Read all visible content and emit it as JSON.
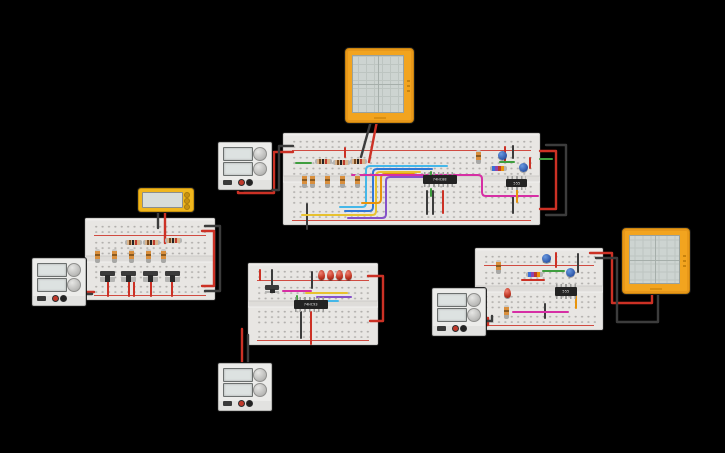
{
  "canvas": {
    "width": 725,
    "height": 453,
    "background": "#000000",
    "kind": "circuit-design-workspace"
  },
  "palette": {
    "wire_red": "#cc3125",
    "wire_black": "#3c3c3c",
    "wire_yellow": "#e7c12f",
    "wire_orange": "#e8940c",
    "wire_cyan": "#45b7e8",
    "wire_blue": "#3178d6",
    "wire_purple": "#8551c9",
    "wire_magenta": "#d62fa4",
    "wire_green": "#3f9e3f",
    "breadboard_body": "#e8e6e3",
    "rail_line_red": "#d04b41",
    "scope_frame": "#f2a41f",
    "scope_screen": "#cdd4d1",
    "meter_body": "#f0b71d",
    "psu_body": "#ececea",
    "ic_body": "#232323",
    "led_red": "#c23a28",
    "capacitor_blue": "#2c55a8",
    "resistor_tan": "#d9b48c"
  },
  "ics": {
    "and_gate_top": {
      "label": "74HC08"
    },
    "timer_top": {
      "label": "555"
    },
    "counter_mid": {
      "label": "74HC93"
    },
    "timer_right": {
      "label": "555"
    }
  },
  "instruments": {
    "power_supplies": [
      {
        "id": "power-supply-1",
        "position": "top-left"
      },
      {
        "id": "power-supply-2",
        "position": "left"
      },
      {
        "id": "power-supply-3",
        "position": "bottom-middle"
      },
      {
        "id": "power-supply-4",
        "position": "right"
      }
    ],
    "oscilloscopes": [
      {
        "id": "oscilloscope-1",
        "position": "top"
      },
      {
        "id": "oscilloscope-2",
        "position": "right"
      }
    ],
    "multimeters": [
      {
        "id": "multimeter-1",
        "position": "left"
      }
    ]
  },
  "boards": {
    "top": {
      "horizontal_resistors": 3,
      "vertical_resistors": 6,
      "capacitors": 2,
      "ics": 2,
      "jumper_colors": [
        "cyan",
        "blue",
        "yellow",
        "orange",
        "purple",
        "magenta",
        "green",
        "red",
        "black"
      ]
    },
    "left": {
      "horizontal_resistors": 3,
      "vertical_resistors": 5,
      "slide_switches": 4,
      "jumper_colors": [
        "red",
        "black"
      ]
    },
    "middle": {
      "leds": 4,
      "slide_switches": 1,
      "ics": 1,
      "jumper_colors": [
        "magenta",
        "yellow",
        "purple",
        "cyan",
        "green",
        "red",
        "black"
      ]
    },
    "right": {
      "leds": 1,
      "capacitors": 2,
      "resistors": 3,
      "ics": 1,
      "jumper_colors": [
        "magenta",
        "green",
        "orange",
        "red",
        "black"
      ]
    }
  }
}
